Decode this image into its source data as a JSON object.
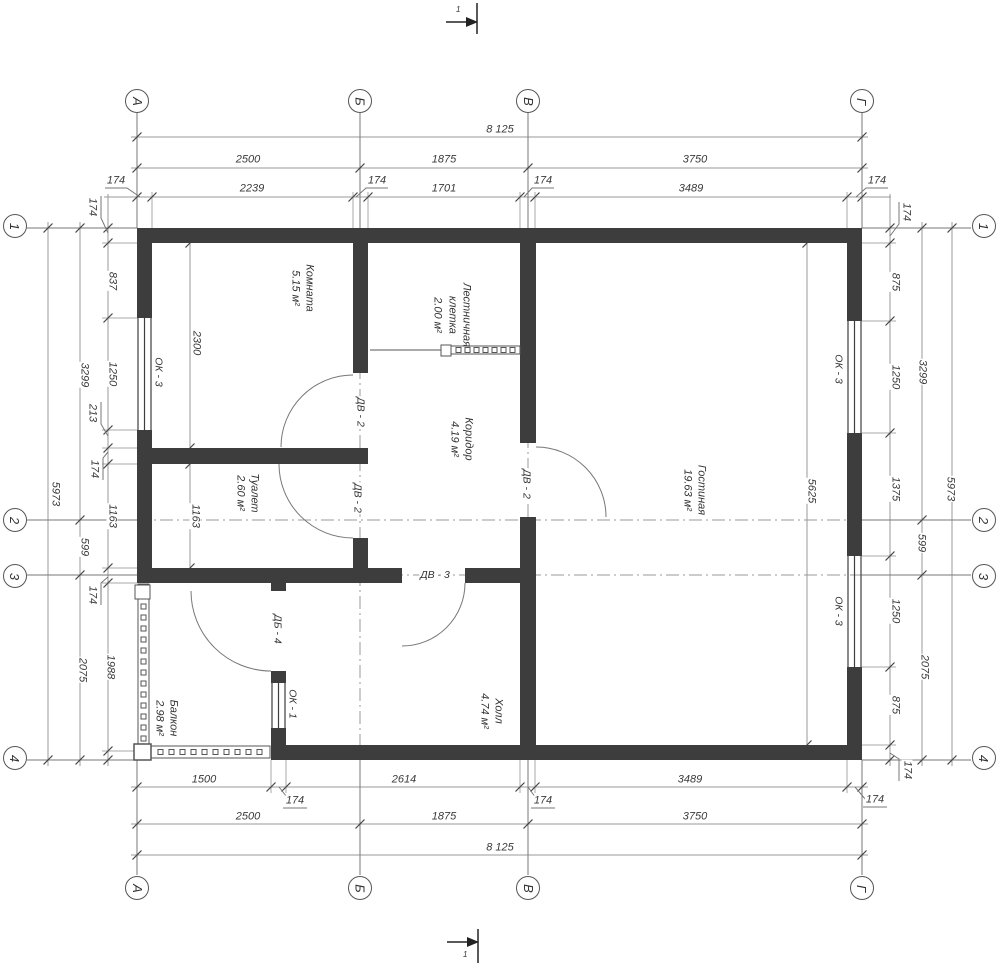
{
  "colors": {
    "wall": "#3d3d3d",
    "dim_line": "#999999",
    "tick": "#444444",
    "text": "#3a3a3a"
  },
  "axis_bubbles": [
    {
      "label": "А",
      "x": 137,
      "y": 101
    },
    {
      "label": "Б",
      "x": 360,
      "y": 101
    },
    {
      "label": "В",
      "x": 528,
      "y": 101
    },
    {
      "label": "Г",
      "x": 862,
      "y": 101
    },
    {
      "label": "А",
      "x": 137,
      "y": 888
    },
    {
      "label": "Б",
      "x": 360,
      "y": 888
    },
    {
      "label": "В",
      "x": 528,
      "y": 888
    },
    {
      "label": "Г",
      "x": 862,
      "y": 888
    },
    {
      "label": "1",
      "x": 15,
      "y": 226
    },
    {
      "label": "2",
      "x": 15,
      "y": 520
    },
    {
      "label": "3",
      "x": 15,
      "y": 576
    },
    {
      "label": "4",
      "x": 15,
      "y": 758
    },
    {
      "label": "1",
      "x": 984,
      "y": 226
    },
    {
      "label": "2",
      "x": 984,
      "y": 520
    },
    {
      "label": "3",
      "x": 984,
      "y": 576
    },
    {
      "label": "4",
      "x": 984,
      "y": 758
    }
  ],
  "dimension_labels": [
    {
      "text": "8 125",
      "x": 500,
      "y": 130,
      "r": 0
    },
    {
      "text": "2500",
      "x": 248,
      "y": 160,
      "r": 0
    },
    {
      "text": "1875",
      "x": 444,
      "y": 160,
      "r": 0
    },
    {
      "text": "3750",
      "x": 695,
      "y": 160,
      "r": 0
    },
    {
      "text": "174",
      "x": 116,
      "y": 181,
      "r": 0
    },
    {
      "text": "2239",
      "x": 252,
      "y": 189,
      "r": 0
    },
    {
      "text": "174",
      "x": 377,
      "y": 181,
      "r": 0
    },
    {
      "text": "1701",
      "x": 444,
      "y": 189,
      "r": 0
    },
    {
      "text": "174",
      "x": 543,
      "y": 181,
      "r": 0
    },
    {
      "text": "3489",
      "x": 691,
      "y": 189,
      "r": 0
    },
    {
      "text": "174",
      "x": 877,
      "y": 181,
      "r": 0
    },
    {
      "text": "1500",
      "x": 204,
      "y": 780,
      "r": 0
    },
    {
      "text": "2614",
      "x": 404,
      "y": 780,
      "r": 0
    },
    {
      "text": "3489",
      "x": 690,
      "y": 780,
      "r": 0
    },
    {
      "text": "174",
      "x": 295,
      "y": 801,
      "r": 0
    },
    {
      "text": "174",
      "x": 543,
      "y": 801,
      "r": 0
    },
    {
      "text": "174",
      "x": 875,
      "y": 800,
      "r": 0
    },
    {
      "text": "2500",
      "x": 248,
      "y": 817,
      "r": 0
    },
    {
      "text": "1875",
      "x": 444,
      "y": 817,
      "r": 0
    },
    {
      "text": "3750",
      "x": 695,
      "y": 817,
      "r": 0
    },
    {
      "text": "8 125",
      "x": 500,
      "y": 848,
      "r": 0
    },
    {
      "text": "174",
      "x": 92,
      "y": 207,
      "r": 90
    },
    {
      "text": "837",
      "x": 112,
      "y": 281,
      "r": 90
    },
    {
      "text": "1250",
      "x": 112,
      "y": 374,
      "r": 90
    },
    {
      "text": "213",
      "x": 92,
      "y": 413,
      "r": 90
    },
    {
      "text": "174",
      "x": 94,
      "y": 469,
      "r": 90
    },
    {
      "text": "1163",
      "x": 112,
      "y": 516,
      "r": 90
    },
    {
      "text": "174",
      "x": 92,
      "y": 595,
      "r": 90
    },
    {
      "text": "1988",
      "x": 110,
      "y": 667,
      "r": 90
    },
    {
      "text": "3299",
      "x": 84,
      "y": 375,
      "r": 90
    },
    {
      "text": "599",
      "x": 84,
      "y": 547,
      "r": 90
    },
    {
      "text": "2075",
      "x": 82,
      "y": 670,
      "r": 90
    },
    {
      "text": "5973",
      "x": 55,
      "y": 494,
      "r": 90
    },
    {
      "text": "174",
      "x": 906,
      "y": 212,
      "r": 90
    },
    {
      "text": "875",
      "x": 895,
      "y": 282,
      "r": 90
    },
    {
      "text": "1250",
      "x": 895,
      "y": 377,
      "r": 90
    },
    {
      "text": "1375",
      "x": 895,
      "y": 489,
      "r": 90
    },
    {
      "text": "1250",
      "x": 895,
      "y": 611,
      "r": 90
    },
    {
      "text": "875",
      "x": 895,
      "y": 705,
      "r": 90
    },
    {
      "text": "174",
      "x": 907,
      "y": 770,
      "r": 90
    },
    {
      "text": "3299",
      "x": 922,
      "y": 372,
      "r": 90
    },
    {
      "text": "599",
      "x": 921,
      "y": 543,
      "r": 90
    },
    {
      "text": "2075",
      "x": 924,
      "y": 667,
      "r": 90
    },
    {
      "text": "5973",
      "x": 950,
      "y": 489,
      "r": 90
    },
    {
      "text": "2300",
      "x": 196,
      "y": 343,
      "r": 90
    },
    {
      "text": "1163",
      "x": 195,
      "y": 516,
      "r": 90
    },
    {
      "text": "5625",
      "x": 811,
      "y": 491,
      "r": 90
    }
  ],
  "room_labels": [
    {
      "lines": [
        "Комната",
        "5.15 м²"
      ],
      "x": 302,
      "y": 288
    },
    {
      "lines": [
        "Лестничная",
        "клетка",
        "2.00 м²"
      ],
      "x": 452,
      "y": 315
    },
    {
      "lines": [
        "Коридор",
        "4.19 м²"
      ],
      "x": 461,
      "y": 439
    },
    {
      "lines": [
        "Гостиная",
        "19.63 м²"
      ],
      "x": 694,
      "y": 490
    },
    {
      "lines": [
        "Туалет",
        "2.60 м²"
      ],
      "x": 247,
      "y": 493
    },
    {
      "lines": [
        "Балкон",
        "2.98 м²"
      ],
      "x": 166,
      "y": 718
    },
    {
      "lines": [
        "Холл",
        "4.74 м²"
      ],
      "x": 491,
      "y": 711
    }
  ],
  "opening_labels": [
    {
      "text": "ОК - 3",
      "x": 158,
      "y": 372,
      "r": 90
    },
    {
      "text": "ОК - 3",
      "x": 838,
      "y": 369,
      "r": 90
    },
    {
      "text": "ОК - 3",
      "x": 838,
      "y": 611,
      "r": 90
    },
    {
      "text": "ОК - 1",
      "x": 292,
      "y": 704,
      "r": 90
    },
    {
      "text": "ДВ - 2",
      "x": 360,
      "y": 412,
      "r": 90
    },
    {
      "text": "ДВ - 2",
      "x": 357,
      "y": 498,
      "r": 90
    },
    {
      "text": "ДВ - 2",
      "x": 526,
      "y": 484,
      "r": 90
    },
    {
      "text": "ДВ - 3",
      "x": 435,
      "y": 575,
      "r": 0
    },
    {
      "text": "ДБ - 4",
      "x": 277,
      "y": 629,
      "r": 90
    }
  ],
  "section_marks": [
    {
      "text": "1",
      "x": 456,
      "y": 6
    },
    {
      "text": "1",
      "x": 463,
      "y": 951
    }
  ]
}
